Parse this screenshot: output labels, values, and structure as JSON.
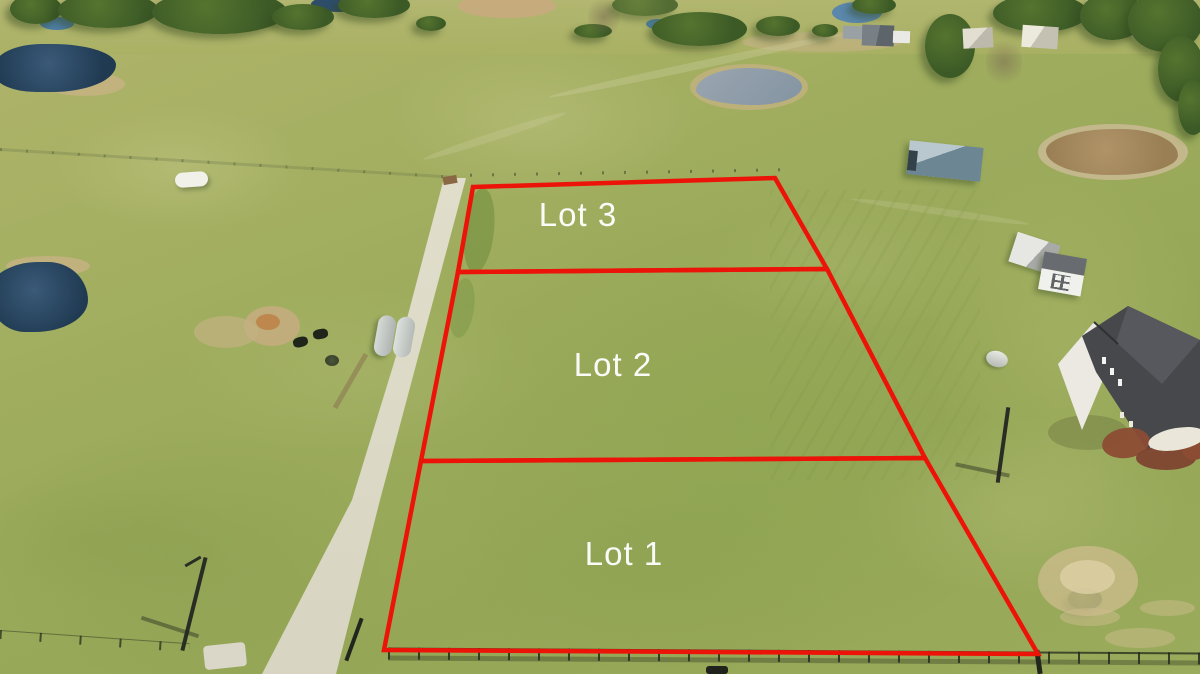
{
  "overlay": {
    "lots": [
      {
        "id": "lot-3",
        "label": "Lot 3"
      },
      {
        "id": "lot-2",
        "label": "Lot 2"
      },
      {
        "id": "lot-1",
        "label": "Lot 1"
      }
    ]
  },
  "colors": {
    "boundary_red": "#ec1408",
    "label_text": "#ffffff"
  }
}
